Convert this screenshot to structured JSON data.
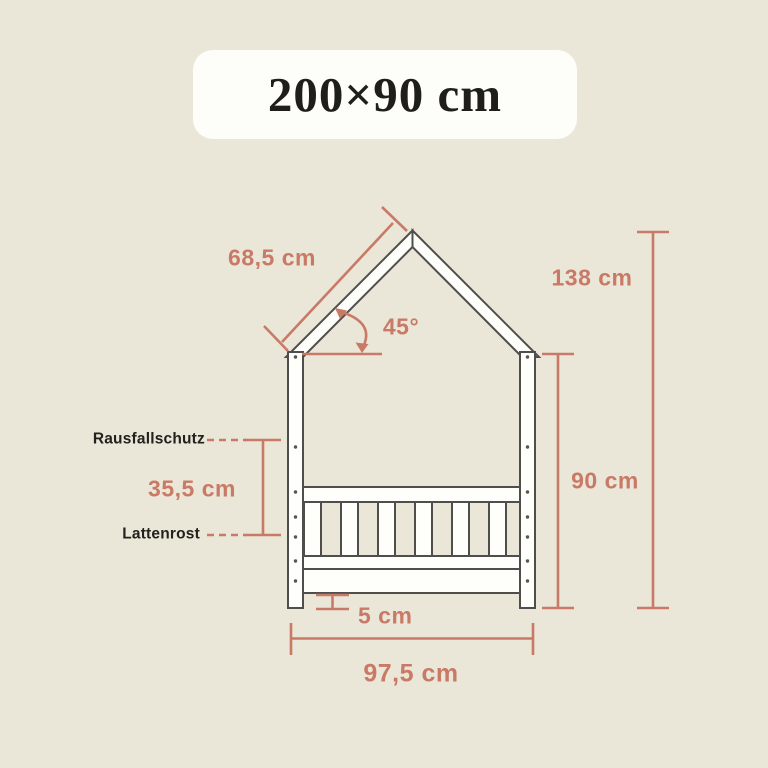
{
  "title": {
    "text": "200×90 cm"
  },
  "diagram": {
    "type": "house-bed dimension drawing",
    "labels": {
      "guard_rail": "Rausfallschutz",
      "slatted_base": "Lattenrost"
    },
    "dimensions": {
      "roof_slope_length": "68,5 cm",
      "roof_angle": "45°",
      "total_height": "138 cm",
      "wall_height": "90 cm",
      "guard_rail_height": "35,5 cm",
      "floor_clearance": "5 cm",
      "outer_width": "97,5 cm"
    }
  },
  "colors": {
    "background": "#EAE6D8",
    "card": "#FDFDF9",
    "accent": "#C97A67",
    "ink": "#23211D",
    "outline": "#4E4E4C",
    "wood_fill": "#FEFEFB"
  }
}
